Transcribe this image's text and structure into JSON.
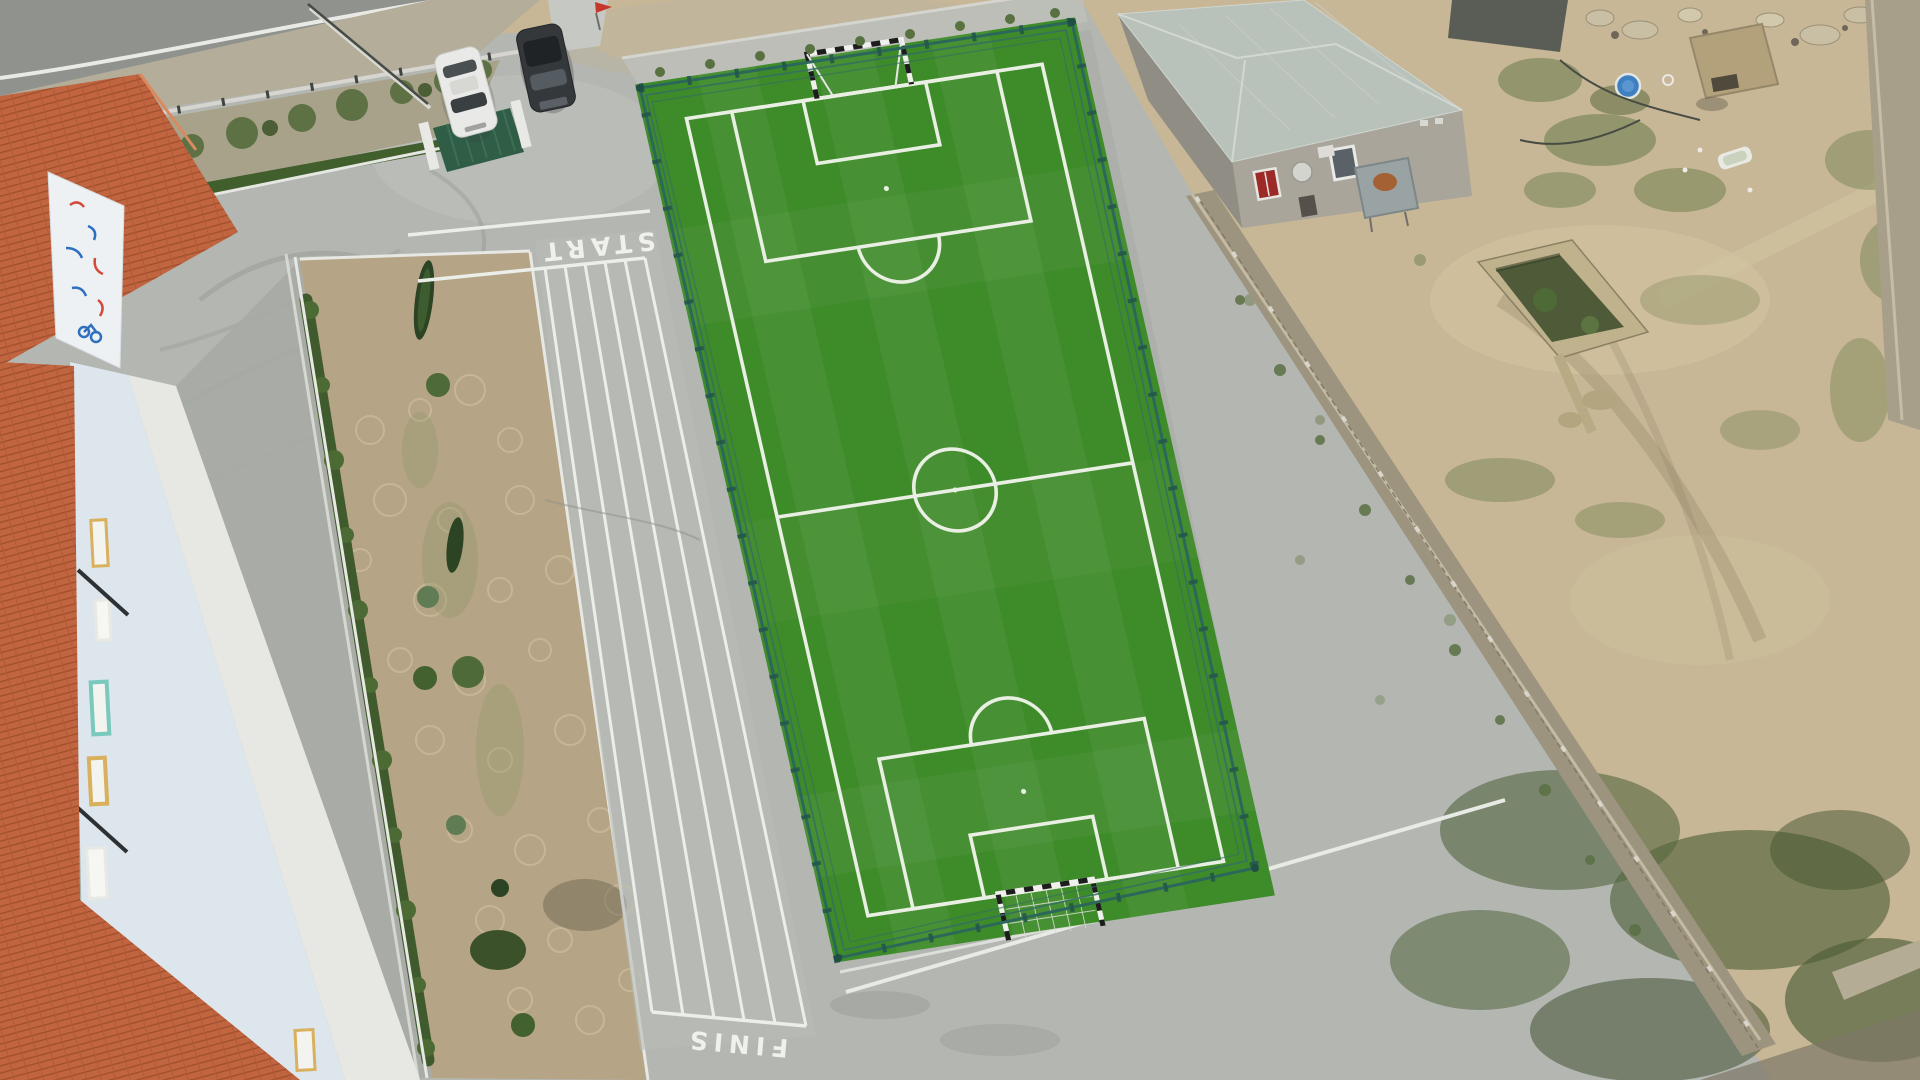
{
  "track": {
    "start_label": "START",
    "finish_label": "FINIS",
    "lane_count": 5
  },
  "pitch": {
    "surface": "artificial-turf",
    "goals": 2,
    "markings": [
      "boundary",
      "halfway-line",
      "center-circle",
      "penalty-areas",
      "goal-areas",
      "penalty-arcs"
    ]
  },
  "vehicles": [
    {
      "type": "car",
      "color": "white"
    },
    {
      "type": "suv",
      "color": "dark-gray"
    }
  ],
  "colors": {
    "turf_green": "#3e8b2a",
    "pitch_line": "#e9efe2",
    "fence_teal": "#2c685a",
    "concrete": "#b3b6b1",
    "sand": "#c7b796",
    "roof_orange": "#c06540",
    "house_roof_gray": "#b9c1bb",
    "hedge_green": "#41592b",
    "stone_wall": "#9d9480",
    "track_line_white": "#eceee9",
    "gate_green": "#2f5d46",
    "flag_red": "#c5392c",
    "pool_blue": "#3f80c2",
    "mural_blue": "#2e6fbf",
    "mural_red": "#d24a3a",
    "window_red": "#9c2a26"
  }
}
